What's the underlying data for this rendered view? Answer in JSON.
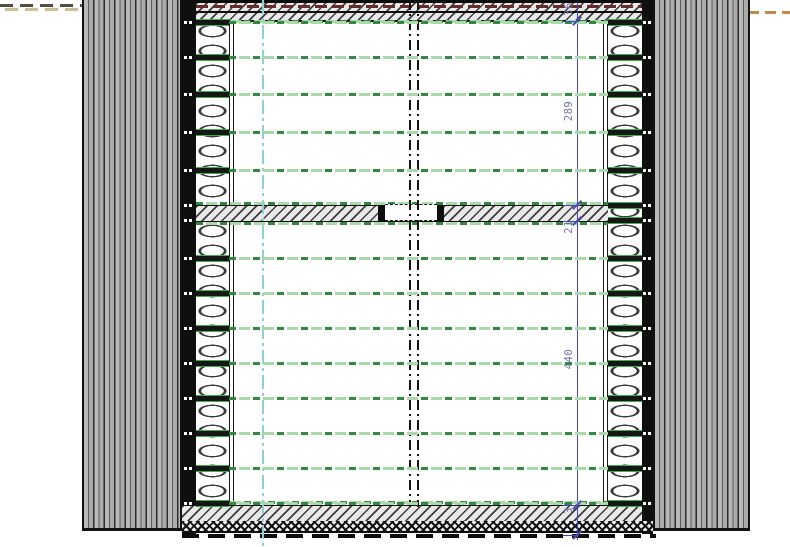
{
  "drawing": {
    "type": "architectural-plan-wall-detail",
    "dimension_chain": {
      "orientation": "vertical",
      "segments": [
        {
          "label": "36",
          "label_center_y": 10
        },
        {
          "label": "289",
          "label_center_y": 112
        },
        {
          "label": "21",
          "label_center_y": 228
        },
        {
          "label": "440",
          "label_center_y": 360
        },
        {
          "label": "32",
          "label_center_y": 508
        }
      ]
    },
    "colors": {
      "dimension_blue": "#4747b8",
      "dimension_text": "#7272ad",
      "batten_green_dark": "#2e8b3d",
      "batten_green_light": "#a9d9a9",
      "centerline_cyan": "#8ed1d1",
      "membrane_red": "#6b2a2a",
      "terrain_left_dark": "#504f42",
      "terrain_left_tan": "#cdbd95",
      "terrain_right_orange": "#c08a4a",
      "cladding_gray": "#ababab",
      "line_black": "#0f0f0f"
    },
    "graphics": {
      "interior_batten_rows_y": [
        22,
        57,
        94,
        132,
        170,
        258,
        293,
        328,
        363,
        398,
        433,
        468,
        503
      ],
      "beam_edge_rows_y": [
        205,
        220
      ],
      "dimension_ticks_y": [
        21,
        205,
        221,
        505,
        535
      ]
    }
  }
}
